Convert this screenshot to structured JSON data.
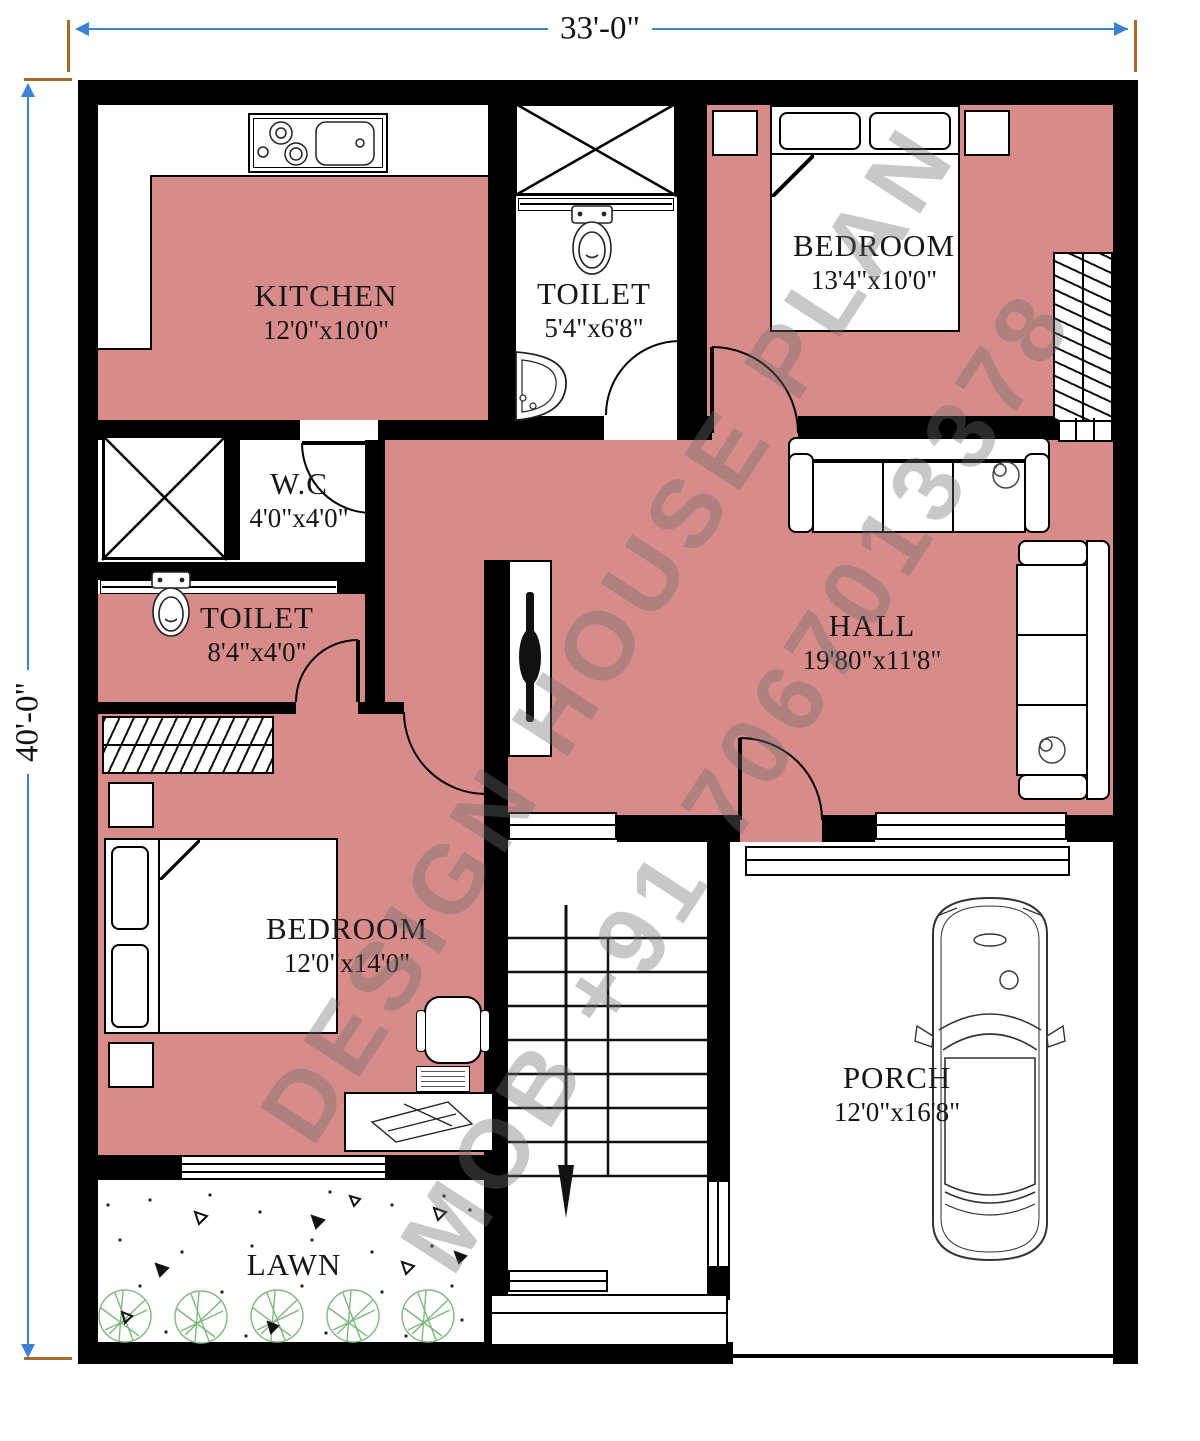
{
  "plan": {
    "dimensions": {
      "width_label": "33'-0\"",
      "height_label": "40'-0\""
    },
    "rooms": [
      {
        "id": "kitchen",
        "name": "KITCHEN",
        "size": "12'0\"x10'0\""
      },
      {
        "id": "toilet-top",
        "name": "TOILET",
        "size": "5'4\"x6'8\""
      },
      {
        "id": "bedroom-top",
        "name": "BEDROOM",
        "size": "13'4\"x10'0\""
      },
      {
        "id": "wc",
        "name": "W.C",
        "size": "4'0\"x4'0\""
      },
      {
        "id": "toilet-middle",
        "name": "TOILET",
        "size": "8'4\"x4'0\""
      },
      {
        "id": "hall",
        "name": "HALL",
        "size": "19'80\"x11'8\""
      },
      {
        "id": "bedroom-bottom",
        "name": "BEDROOM",
        "size": "12'0\"x14'0\""
      },
      {
        "id": "porch",
        "name": "PORCH",
        "size": "12'0\"x16'8\""
      },
      {
        "id": "lawn",
        "name": "LAWN",
        "size": ""
      }
    ],
    "watermark": {
      "line1": "DESIGN HOUSE PLAN",
      "line2": "MOB +91 7067013378"
    },
    "colors": {
      "floor": "#d88c8a",
      "wall": "#000000",
      "dimension_line": "#3b82d0",
      "dimension_tick": "#a9682c",
      "tree": "#7fb77f",
      "watermark": "#6e6e6e"
    }
  }
}
